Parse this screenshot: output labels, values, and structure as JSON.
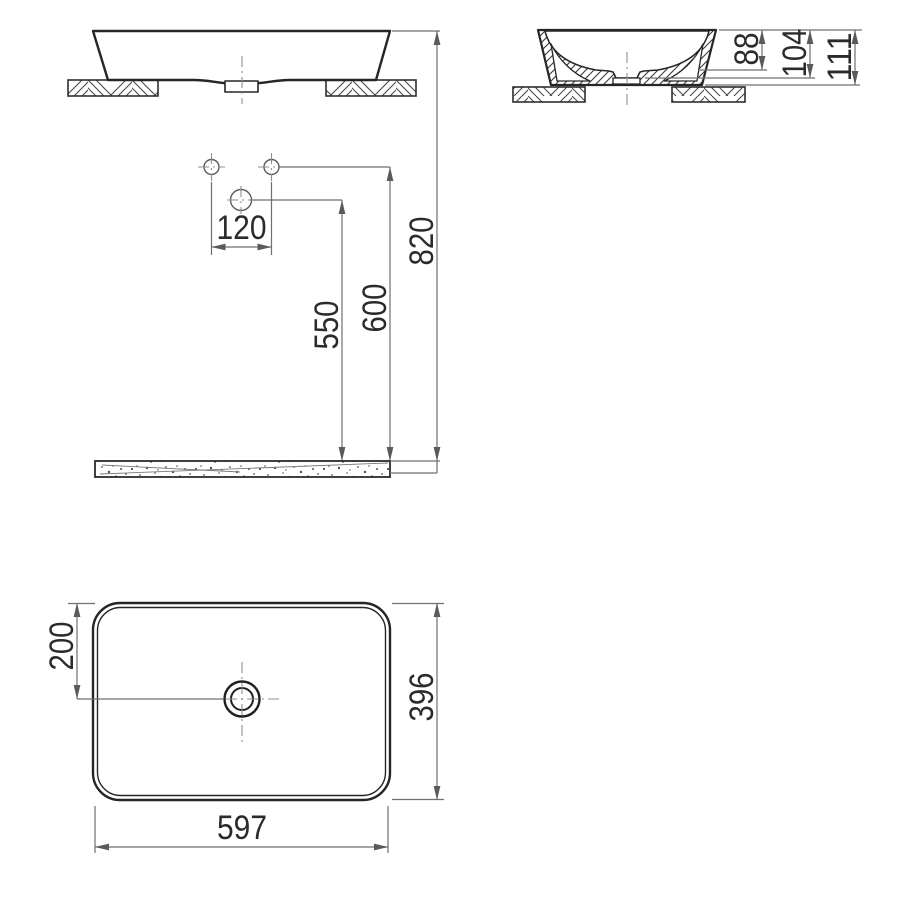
{
  "colors": {
    "background": "#ffffff",
    "object_line": "#262626",
    "dimension_line": "#6f6f6f",
    "centerline": "#8f8f8f",
    "text": "#2b2b2b"
  },
  "dimensions": {
    "hole_spacing": "120",
    "drain_outlet_height": "550",
    "supply_height": "600",
    "rim_height": "820",
    "bowl_depth": "88",
    "inner_depth": "104",
    "overall_height": "111",
    "drain_offset": "200",
    "basin_width": "396",
    "basin_length": "597"
  }
}
